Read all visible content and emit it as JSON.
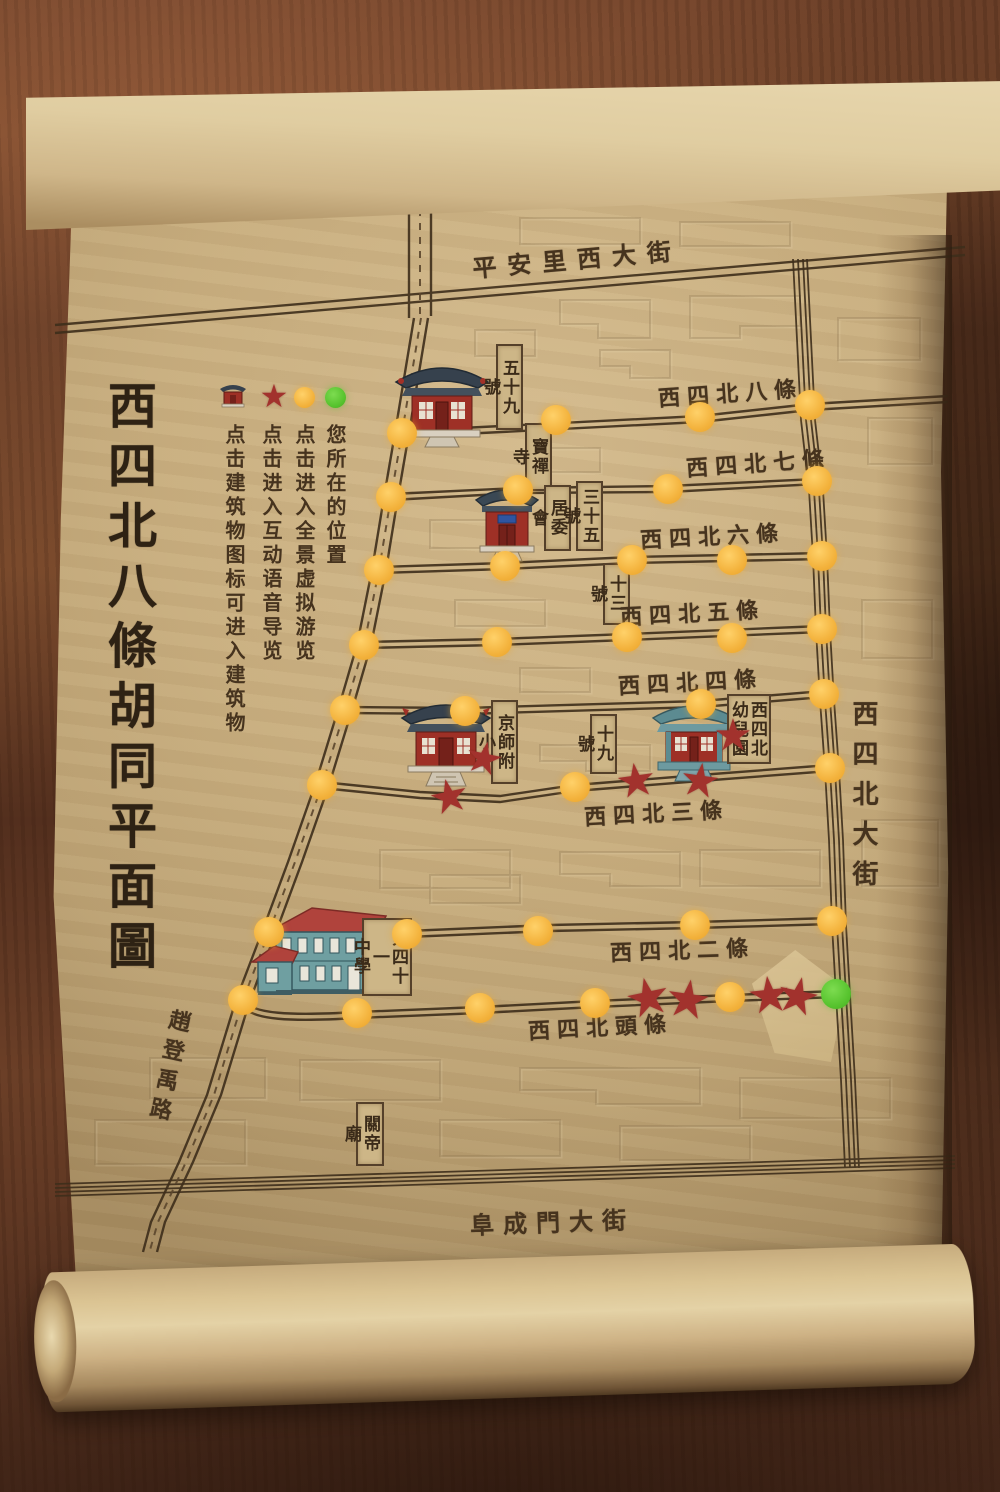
{
  "scroll": {
    "title": "西四北八條胡同平面圖"
  },
  "legend": {
    "building_label": "点击建筑物图标可进入建筑物",
    "star_label": "点击进入互动语音导览",
    "yellow_label": "点击进入全景虚拟游览",
    "green_label": "您所在的位置"
  },
  "streets": {
    "top": "平安里西大街",
    "right_vertical": "西四北大街",
    "bottom": "阜成門大街",
    "left_diagonal": "趙登禹路",
    "hutongs": [
      "西四北八條",
      "西四北七條",
      "西四北六條",
      "西四北五條",
      "西四北四條",
      "西四北三條",
      "西四北二條",
      "西四北頭條"
    ]
  },
  "places": {
    "no59": "五十九號",
    "baochan_temple": "寶禪寺",
    "residents_committee": "居委會",
    "no35": "三十五號",
    "no13": "十三號",
    "jingshi_primary": "京師附小",
    "no19": "十九號",
    "kindergarten": "西四北\n幼兒園",
    "middle_school_41": "第四十一\n中學",
    "guandi_temple": "關帝廟"
  },
  "markers": {
    "star_glyph": "★",
    "yellow_dots": [
      [
        402,
        433
      ],
      [
        556,
        420
      ],
      [
        700,
        417
      ],
      [
        810,
        405
      ],
      [
        391,
        497
      ],
      [
        518,
        490
      ],
      [
        668,
        489
      ],
      [
        817,
        481
      ],
      [
        379,
        570
      ],
      [
        505,
        566
      ],
      [
        632,
        560
      ],
      [
        732,
        560
      ],
      [
        822,
        556
      ],
      [
        364,
        645
      ],
      [
        497,
        642
      ],
      [
        627,
        637
      ],
      [
        732,
        638
      ],
      [
        822,
        629
      ],
      [
        345,
        710
      ],
      [
        465,
        711
      ],
      [
        701,
        704
      ],
      [
        824,
        694
      ],
      [
        322,
        785
      ],
      [
        575,
        787
      ],
      [
        830,
        768
      ],
      [
        269,
        932
      ],
      [
        407,
        934
      ],
      [
        538,
        931
      ],
      [
        695,
        925
      ],
      [
        832,
        921
      ],
      [
        243,
        1000
      ],
      [
        357,
        1013
      ],
      [
        480,
        1008
      ],
      [
        595,
        1003
      ],
      [
        730,
        997
      ]
    ],
    "red_stars": [
      [
        449,
        796,
        -12,
        46
      ],
      [
        484,
        759,
        12,
        44
      ],
      [
        636,
        780,
        -8,
        46
      ],
      [
        700,
        780,
        8,
        46
      ],
      [
        733,
        736,
        0,
        44
      ],
      [
        648,
        998,
        -12,
        52
      ],
      [
        688,
        1000,
        8,
        52
      ],
      [
        769,
        995,
        -6,
        50
      ],
      [
        798,
        996,
        12,
        50
      ]
    ],
    "green_dots": [
      [
        836,
        994
      ]
    ]
  },
  "colors": {
    "accent_yellow": "#f3b23c",
    "accent_green": "#57c32e",
    "star_red": "#a2322d",
    "ink": "#46331e",
    "parchment": "#c8ae7f"
  }
}
